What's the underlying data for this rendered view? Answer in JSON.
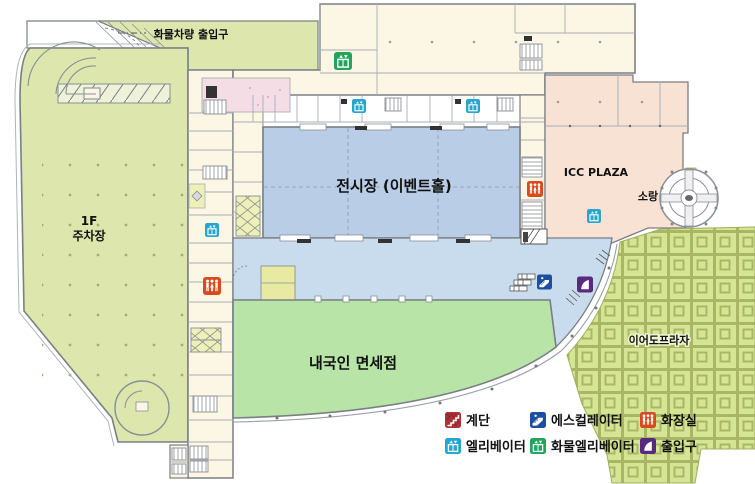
{
  "map": {
    "labels": {
      "cargo_entrance": "화물차량 출입구",
      "parking_line1": "1F",
      "parking_line2": "주차장",
      "exhibition_hall": "전시장 (이벤트홀)",
      "duty_free": "내국인 면세점",
      "icc_plaza": "ICC PLAZA",
      "sorang": "소랑",
      "ieodo_plaza": "이어도프라자"
    },
    "colors": {
      "parking": "#dce6ad",
      "rooms": "#fcf7e4",
      "exhibition_hall": "#b9cde6",
      "lobby": "#c9dcee",
      "duty_free": "#b9e4a8",
      "icc_plaza": "#f8e2d4",
      "pink_room": "#f5dde6",
      "plaza": "#d6e496",
      "yellow_room": "#e9eaa2",
      "wall": "#7a7f85"
    }
  },
  "legend": {
    "items": [
      {
        "id": "stairs",
        "label": "계단",
        "color": "#b03038"
      },
      {
        "id": "escalator",
        "label": "에스컬레이터",
        "color": "#1c4f9e"
      },
      {
        "id": "restroom",
        "label": "화장실",
        "color": "#d94b1c"
      },
      {
        "id": "elevator",
        "label": "엘리베이터",
        "color": "#25a6cd"
      },
      {
        "id": "cargo-elevator",
        "label": "화물엘리베이터",
        "color": "#23a45c"
      },
      {
        "id": "entrance",
        "label": "출입구",
        "color": "#582a7e"
      }
    ]
  }
}
